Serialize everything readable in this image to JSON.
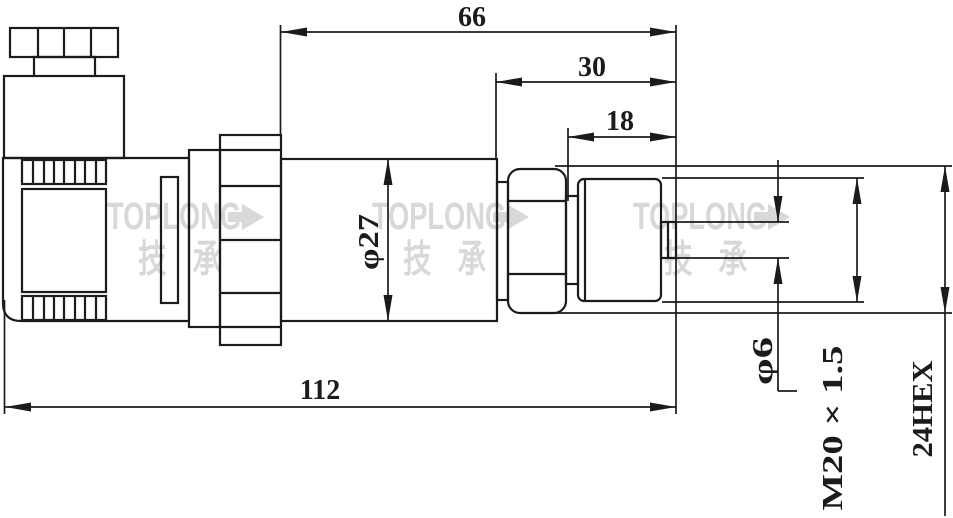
{
  "drawing": {
    "type": "technical-dimension-drawing",
    "dimensions": {
      "top_width": "66",
      "mid_width": "30",
      "thread_length": "18",
      "overall_length": "112",
      "body_diameter": "φ27",
      "port_diameter": "φ6",
      "thread_spec": "M20 × 1.5",
      "hex_size": "24HEX"
    },
    "watermark": {
      "brand": "TOPLONG",
      "arrow_icon": "arrow-right",
      "cjk": "技 承"
    },
    "colors": {
      "line": "#1b1b1b",
      "watermark": "#d8d8d8",
      "background": "#ffffff"
    }
  }
}
